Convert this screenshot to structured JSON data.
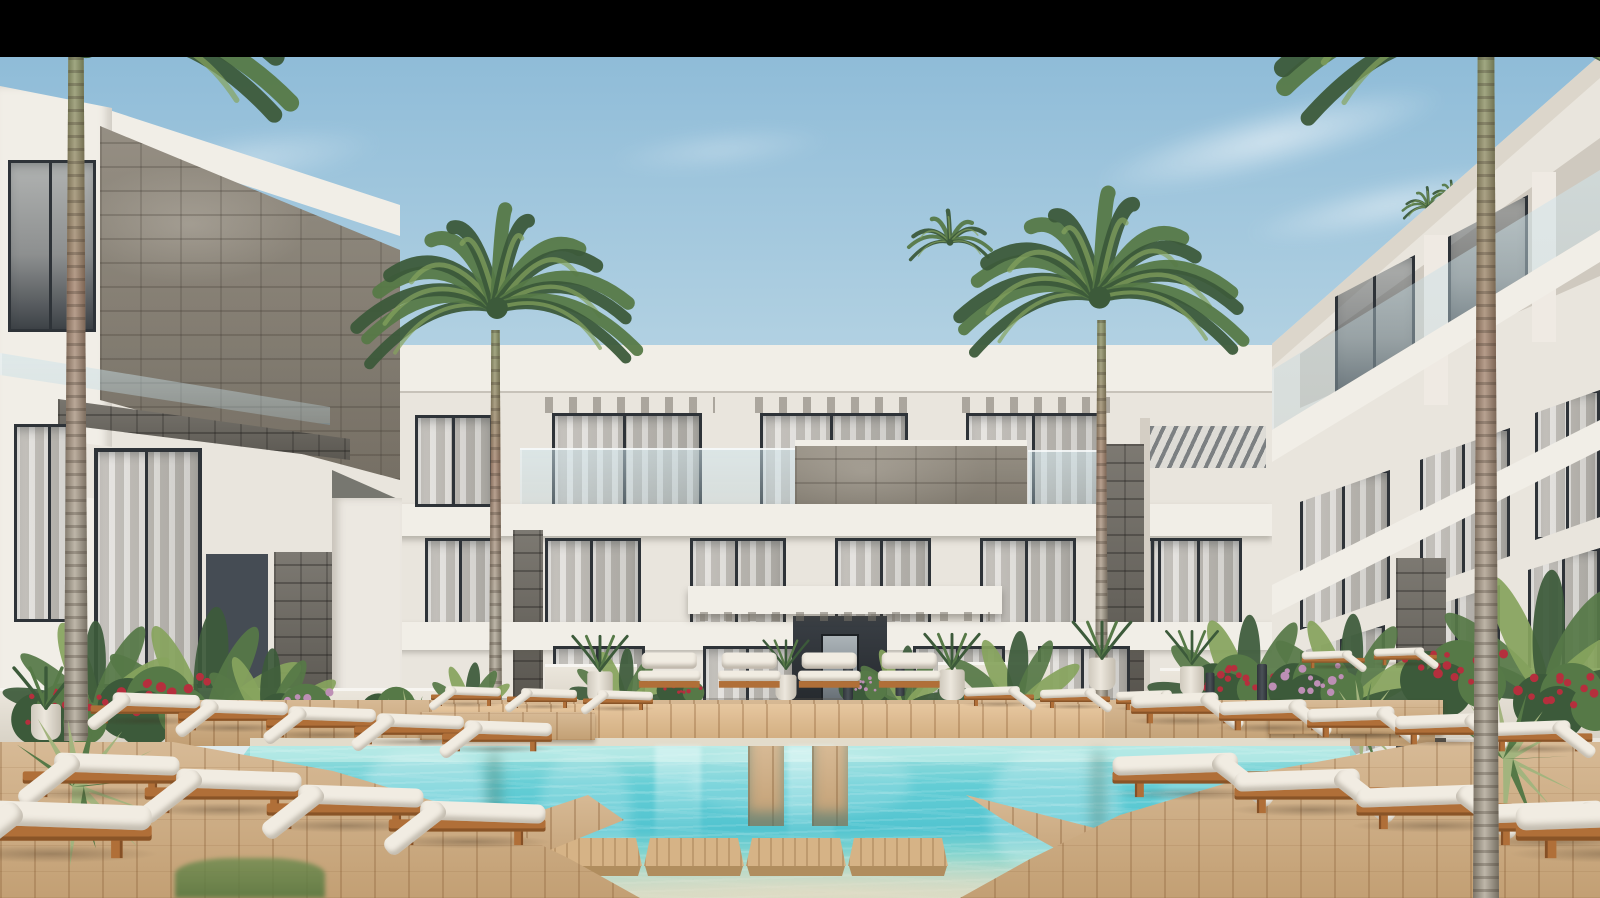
{
  "meta": {
    "type": "architectural-render",
    "subject": "Modern white resort apartment complex courtyard with turquoise swimming pool, wooden deck, white sun loungers, flowering planters and tall palm trees under a light blue sky",
    "width": 1600,
    "height": 898
  },
  "letterbox": {
    "color": "#000000",
    "top_height": 57
  },
  "palette": {
    "letterbox": "#000000",
    "sky_top": "#8fbcd8",
    "sky_mid": "#b5d3e3",
    "sky_low": "#cfe2ea",
    "sky_horizon": "#dfeaec",
    "cloud": "rgba(255,255,255,0.75)",
    "building_white": "#e9e5dd",
    "building_bright": "#f1eee7",
    "building_shade": "#d4cec4",
    "dark_panel": "#454c54",
    "grey_panel": "#868a89",
    "stone_mid": "#968e80",
    "stone_dark": "#6e6a62",
    "window_frame": "#2e3338",
    "curtain_light": "#dcd9d4",
    "curtain_mid": "#c2bfb9",
    "curtain_dim": "#aeaca6",
    "wood_deck": "#cda87a",
    "wood_plat": "#d6b386",
    "wood_plat_dark": "#b08d5e",
    "wood_lounger": "#b06f38",
    "cushion": "#f1ece2",
    "pool_far": "#a2e1de",
    "pool_mid": "#63cdd5",
    "pool_deep": "#52c4d0",
    "pool_mid2": "#8fd8cf",
    "pool_shallow": "#d5dcc4",
    "leaf_dark": "#3c5a3a",
    "leaf_mid": "#567947",
    "leaf_light": "#86a45e",
    "agave": "#a3b47e",
    "flower_red": "#b52f3d",
    "flower_pink": "#bd8fb5",
    "palm_trunk": "#a89e8c",
    "palm_trunk_green": "#7f8a57",
    "palm_trunk_boot": "#9d7a62",
    "planter_white": "#ece7dd"
  },
  "scene": {
    "clouds": [
      {
        "x": 1010,
        "y": 95,
        "w": 520,
        "h": 90,
        "rot": -14,
        "o": 0.75
      },
      {
        "x": 1180,
        "y": 170,
        "w": 420,
        "h": 70,
        "rot": -12,
        "o": 0.6
      },
      {
        "x": 60,
        "y": 120,
        "w": 380,
        "h": 80,
        "rot": -8,
        "o": 0.45
      },
      {
        "x": 560,
        "y": 120,
        "w": 320,
        "h": 60,
        "rot": -6,
        "o": 0.35
      }
    ],
    "palms": [
      {
        "name": "palm-left-edge",
        "layer": "edge-back",
        "cx": 86,
        "cy": 42,
        "len": 235,
        "n": 15,
        "trunk": {
          "x": 64,
          "y": 57,
          "w": 24,
          "h": 684
        }
      },
      {
        "name": "palm-center-left",
        "layer": "mid",
        "cx": 497,
        "cy": 308,
        "len": 155,
        "n": 15,
        "trunk": {
          "x": 489,
          "y": 330,
          "w": 13,
          "h": 396
        }
      },
      {
        "name": "palm-center-right",
        "layer": "mid",
        "cx": 1099,
        "cy": 298,
        "len": 158,
        "n": 15,
        "trunk": {
          "x": 1095,
          "y": 320,
          "w": 13,
          "h": 412
        }
      },
      {
        "name": "palm-right-edge",
        "layer": "edge-front",
        "cx": 1487,
        "cy": 40,
        "len": 230,
        "n": 15,
        "trunk": {
          "x": 1473,
          "y": 57,
          "w": 26,
          "h": 841
        }
      }
    ],
    "small_palms": [
      {
        "cx": 950,
        "cy": 242,
        "len": 48
      },
      {
        "cx": 318,
        "cy": 368,
        "len": 40
      },
      {
        "cx": 288,
        "cy": 382,
        "len": 30
      },
      {
        "cx": 540,
        "cy": 395,
        "len": 30
      },
      {
        "cx": 1428,
        "cy": 208,
        "len": 30
      },
      {
        "cx": 1452,
        "cy": 197,
        "len": 24
      }
    ],
    "lounger_groups": [
      {
        "name": "left-rear-row",
        "layer": "front",
        "type": "side",
        "dir": "right",
        "x": 86,
        "y": 664,
        "dx": 88,
        "dy": 7,
        "count": 5,
        "s": 0.78
      },
      {
        "name": "left-front-row",
        "layer": "front",
        "type": "side",
        "dir": "right",
        "x": 16,
        "y": 712,
        "dx": 122,
        "dy": 16,
        "count": 4,
        "s": 1.12
      },
      {
        "name": "left-corner",
        "layer": "front",
        "type": "side",
        "dir": "right",
        "x": -60,
        "y": 748,
        "dx": 0,
        "dy": 0,
        "count": 1,
        "s": 1.45
      },
      {
        "name": "left-upper-row",
        "layer": "mid",
        "type": "side",
        "dir": "right",
        "x": 428,
        "y": 668,
        "dx": 76,
        "dy": 2,
        "count": 3,
        "s": 0.5
      },
      {
        "name": "entrance-row",
        "layer": "mid",
        "type": "front",
        "dir": "right",
        "x": 636,
        "y": 644,
        "dx": 80,
        "dy": 0,
        "count": 4,
        "s": 0.95
      },
      {
        "name": "right-upper-row",
        "layer": "mid",
        "type": "side",
        "dir": "left",
        "x": 962,
        "y": 668,
        "dx": 76,
        "dy": 2,
        "count": 3,
        "s": 0.5
      },
      {
        "name": "right-terrace-row",
        "layer": "mid",
        "type": "side",
        "dir": "left",
        "x": 1300,
        "y": 634,
        "dx": 72,
        "dy": -3,
        "count": 2,
        "s": 0.45
      },
      {
        "name": "right-rear-row",
        "layer": "front",
        "type": "side",
        "dir": "left",
        "x": 1128,
        "y": 664,
        "dx": 88,
        "dy": 7,
        "count": 5,
        "s": 0.78
      },
      {
        "name": "right-front-row",
        "layer": "front",
        "type": "side",
        "dir": "left",
        "x": 1108,
        "y": 712,
        "dx": 122,
        "dy": 16,
        "count": 4,
        "s": 1.12
      },
      {
        "name": "right-corner",
        "layer": "front",
        "type": "side",
        "dir": "left",
        "x": 1510,
        "y": 748,
        "dx": 0,
        "dy": 0,
        "count": 1,
        "s": 1.45
      }
    ],
    "plants": [
      {
        "type": "banana",
        "layer": "garden",
        "x": 205,
        "y": 740,
        "s": 1.2
      },
      {
        "type": "banana",
        "layer": "garden",
        "x": 95,
        "y": 720,
        "s": 0.95
      },
      {
        "type": "banana",
        "layer": "garden",
        "x": 268,
        "y": 735,
        "s": 0.8
      },
      {
        "type": "banana",
        "layer": "garden",
        "x": 625,
        "y": 712,
        "s": 0.6
      },
      {
        "type": "banana",
        "layer": "garden",
        "x": 905,
        "y": 710,
        "s": 0.6
      },
      {
        "type": "banana",
        "layer": "garden",
        "x": 1015,
        "y": 718,
        "s": 0.8
      },
      {
        "type": "banana",
        "layer": "garden",
        "x": 1248,
        "y": 720,
        "s": 1.0
      },
      {
        "type": "banana",
        "layer": "garden",
        "x": 1350,
        "y": 715,
        "s": 0.95
      },
      {
        "type": "banana",
        "layer": "garden",
        "x": 1545,
        "y": 705,
        "s": 1.25
      },
      {
        "type": "banana",
        "layer": "garden",
        "x": 470,
        "y": 718,
        "s": 0.5
      },
      {
        "type": "bush",
        "c": "flower_red",
        "layer": "garden",
        "x": 152,
        "y": 742,
        "s": 1.05
      },
      {
        "type": "bush",
        "c": "flower_red",
        "layer": "garden",
        "x": 58,
        "y": 748,
        "s": 0.9
      },
      {
        "type": "bush",
        "c": "flower_pink",
        "layer": "garden",
        "x": 300,
        "y": 745,
        "s": 0.85
      },
      {
        "type": "bush",
        "c": "",
        "layer": "garden",
        "x": 392,
        "y": 730,
        "s": 0.6
      },
      {
        "type": "bush",
        "c": "flower_red",
        "layer": "garden",
        "x": 680,
        "y": 705,
        "s": 0.45
      },
      {
        "type": "bush",
        "c": "flower_pink",
        "layer": "garden",
        "x": 862,
        "y": 703,
        "s": 0.45
      },
      {
        "type": "bush",
        "c": "flower_red",
        "layer": "garden",
        "x": 1232,
        "y": 712,
        "s": 0.8
      },
      {
        "type": "bush",
        "c": "flower_pink",
        "layer": "garden",
        "x": 1315,
        "y": 718,
        "s": 0.9
      },
      {
        "type": "bush",
        "c": "flower_red",
        "layer": "garden",
        "x": 1452,
        "y": 712,
        "s": 1.0
      },
      {
        "type": "bush",
        "c": "flower_red",
        "layer": "fore",
        "x": 1565,
        "y": 735,
        "s": 1.0
      },
      {
        "type": "agave",
        "layer": "fore",
        "x": 78,
        "y": 790,
        "s": 1.15
      },
      {
        "type": "agave",
        "layer": "garden",
        "x": 412,
        "y": 738,
        "s": 0.7
      },
      {
        "type": "agave",
        "layer": "fore",
        "x": 1508,
        "y": 762,
        "s": 1.0
      },
      {
        "type": "agave",
        "layer": "garden",
        "x": 1362,
        "y": 728,
        "s": 0.7
      },
      {
        "type": "pot",
        "layer": "garden",
        "x": 600,
        "y": 702,
        "s": 0.85
      },
      {
        "type": "pot",
        "layer": "garden",
        "x": 786,
        "y": 700,
        "s": 0.7
      },
      {
        "type": "pot",
        "layer": "garden",
        "x": 952,
        "y": 700,
        "s": 0.85
      },
      {
        "type": "pot",
        "layer": "garden",
        "x": 1102,
        "y": 690,
        "s": 0.9
      },
      {
        "type": "pot",
        "layer": "garden",
        "x": 46,
        "y": 740,
        "s": 1.0
      },
      {
        "type": "pot",
        "layer": "garden",
        "x": 1192,
        "y": 695,
        "s": 0.8
      },
      {
        "type": "bollard",
        "layer": "garden",
        "x": 848,
        "y": 700,
        "s": 1
      },
      {
        "type": "bollard",
        "layer": "garden",
        "x": 900,
        "y": 696,
        "s": 0.9
      },
      {
        "type": "bollard",
        "layer": "garden",
        "x": 1262,
        "y": 710,
        "s": 1
      },
      {
        "type": "bollard",
        "layer": "garden",
        "x": 1210,
        "y": 714,
        "s": 0.9
      }
    ],
    "platform_centers": [
      592,
      694,
      796,
      898
    ],
    "pool": {
      "light_channels": [
        {
          "x": 655,
          "w": 46
        },
        {
          "x": 788,
          "w": 46
        }
      ],
      "wood_piers": [
        {
          "x": 748,
          "w": 36
        },
        {
          "x": 812,
          "w": 36
        }
      ]
    }
  }
}
